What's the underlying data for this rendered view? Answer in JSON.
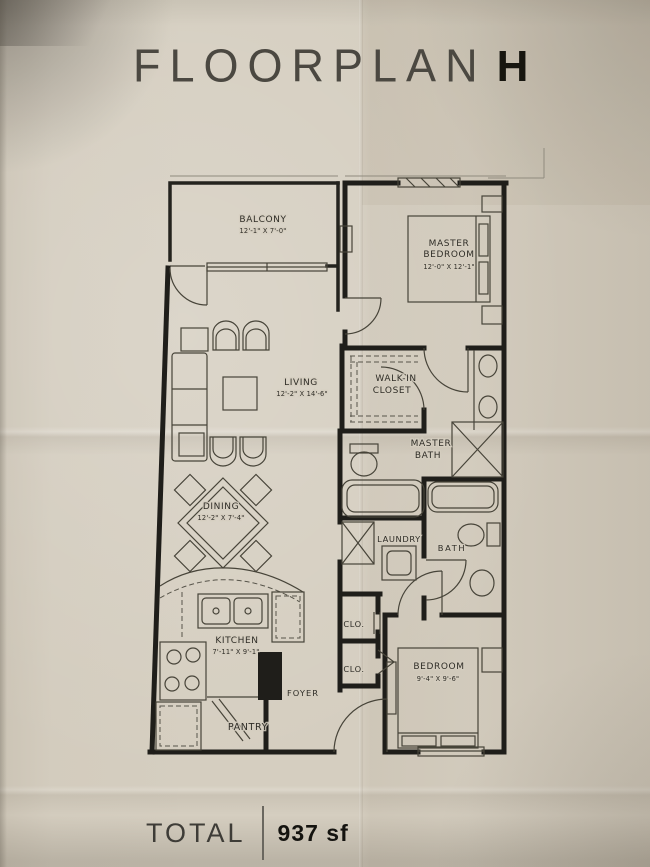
{
  "title": {
    "main": "FLOORPLAN",
    "variant": "H"
  },
  "total": {
    "label": "TOTAL",
    "value": "937 sf"
  },
  "colors": {
    "paper": "#d5cec0",
    "wall_ink": "#1f1e1a",
    "thin_ink": "#474439",
    "text_ink": "#2f2d27"
  },
  "rooms": {
    "balcony": {
      "name": "BALCONY",
      "dims": "12'-1\" X 7'-0\""
    },
    "master_bedroom": {
      "line1": "MASTER",
      "line2": "BEDROOM",
      "dims": "12'-0\" X 12'-1\""
    },
    "living": {
      "name": "LIVING",
      "dims": "12'-2\" X 14'-6\""
    },
    "walk_in_closet": {
      "line1": "WALK-IN",
      "line2": "CLOSET"
    },
    "master_bath": {
      "line1": "MASTER",
      "line2": "BATH"
    },
    "dining": {
      "name": "DINING",
      "dims": "12'-2\" X 7'-4\""
    },
    "laundry": {
      "name": "LAUNDRY"
    },
    "bath": {
      "name": "BATH"
    },
    "kitchen": {
      "name": "KITCHEN",
      "dims": "7'-11\" X 9'-1\""
    },
    "closet_1": {
      "name": "CLO."
    },
    "closet_2": {
      "name": "CLO."
    },
    "foyer": {
      "name": "FOYER"
    },
    "pantry": {
      "name": "PANTRY"
    },
    "bedroom_2": {
      "name": "BEDROOM",
      "dims": "9'-4\" X 9'-6\""
    }
  }
}
